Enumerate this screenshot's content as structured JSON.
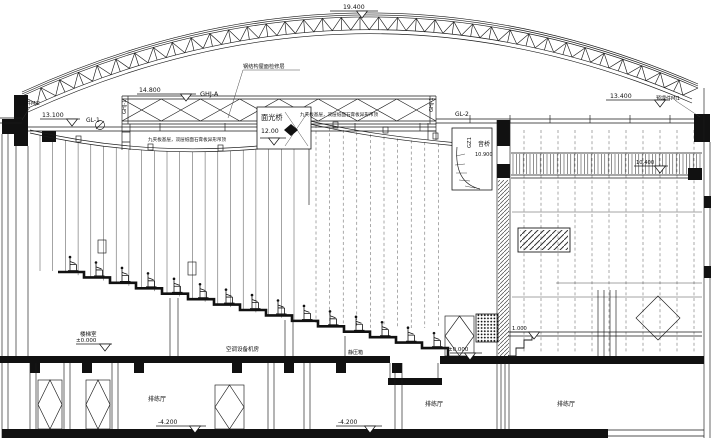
{
  "meta": {
    "type": "theatre-longitudinal-section",
    "ink": "#1a1a1a",
    "background": "#ffffff"
  },
  "roof": {
    "apex_elevation": "19.400",
    "note": "钢结构屋面检修层"
  },
  "maintenance_truss": {
    "elevation": "14.800",
    "name": "GHJ-A",
    "left_column": "GHJ-1",
    "right_column": "GHJ-1"
  },
  "beams": {
    "gl1": {
      "name": "GL-1",
      "elevation": "13.100"
    },
    "gl2": {
      "name": "GL-2",
      "elevation": "13.400"
    },
    "gz1": "GZ1"
  },
  "embeds": {
    "left": "预埋件MJ2",
    "right": "预埋件MJ1"
  },
  "bridges": {
    "light": {
      "name": "面光桥",
      "elevation": "12.00"
    },
    "sound": {
      "name": "音桥",
      "elevation": "10.900"
    }
  },
  "ceiling": {
    "note_left": "九夹板基层，双层纸面石膏板异形吊顶",
    "note_right": "九夹板基层，双层纸面石膏板异形吊顶"
  },
  "stage": {
    "slat_elevation": "10.400",
    "floor_elevation": "1.000",
    "front_elevation": "±0.000"
  },
  "ground": {
    "stair_room": "楼梯室",
    "elevation": "±0.000",
    "ac_room": "空调设备机房",
    "plenum": "静压箱"
  },
  "basement": {
    "room_left": "排练厅",
    "elev_left": "-4.200",
    "elev_mid": "-4.200",
    "room_mid": "排练厅",
    "room_right": "排练厅"
  }
}
